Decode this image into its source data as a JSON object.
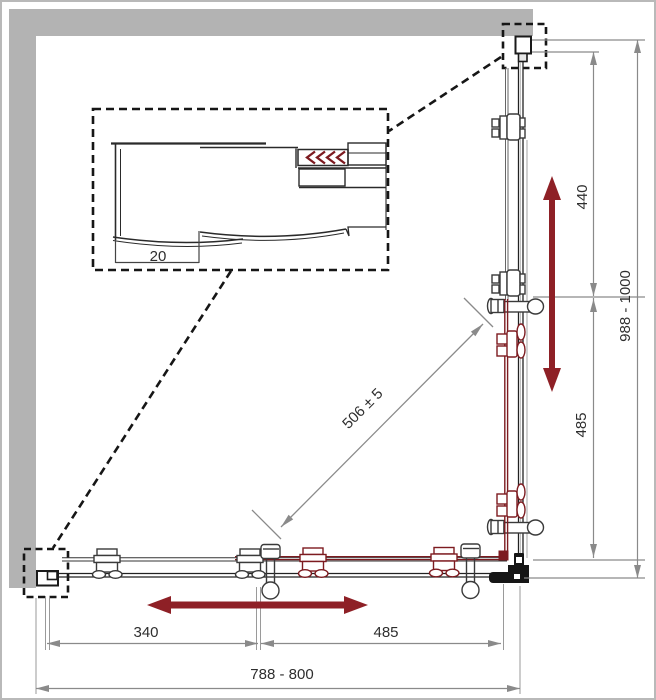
{
  "dimensions": {
    "total_width_range": "788 - 800",
    "bottom_fixed_segment": "340",
    "bottom_door_segment": "485",
    "side_width_range": "988 - 1000",
    "side_upper_segment": "440",
    "side_lower_segment": "485",
    "diagonal_opening": "506 ± 5",
    "profile_adjustment": "20"
  },
  "colors": {
    "wall_gray": "#b3b3b3",
    "outline_black": "#222222",
    "dimension_gray": "#8a8a8a",
    "arrow_red": "#8e2026",
    "component_red": "#7d1b20",
    "text_dark": "#2e2e2e"
  }
}
